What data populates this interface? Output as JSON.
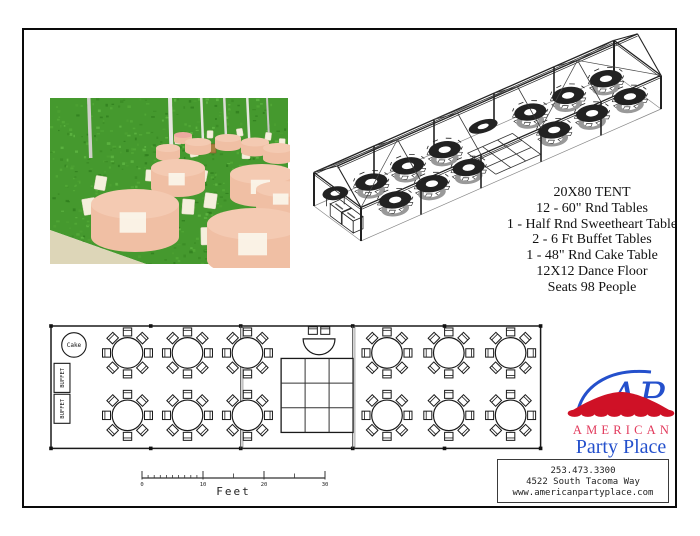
{
  "tent_info": {
    "lines": [
      "20X80 TENT",
      "12 - 60\" Rnd Tables",
      "1 - Half Rnd Sweetheart Table",
      "2 - 6 Ft Buffet Tables",
      "1 - 48\" Rnd Cake Table",
      "12X12 Dance Floor",
      "Seats 98 People"
    ]
  },
  "floor_plan": {
    "tent_length_ft": 80,
    "tent_width_ft": 20,
    "cake_label": "Cake",
    "buffet_label": "BUFFET",
    "chairs_per_table": 8,
    "table_diameter_ft": 5,
    "tables": [
      {
        "u": 12.5,
        "v": 4.4
      },
      {
        "u": 22.3,
        "v": 4.4
      },
      {
        "u": 32.1,
        "v": 4.4
      },
      {
        "u": 12.5,
        "v": 14.6
      },
      {
        "u": 22.3,
        "v": 14.6
      },
      {
        "u": 32.1,
        "v": 14.6
      },
      {
        "u": 54.9,
        "v": 4.4
      },
      {
        "u": 65.0,
        "v": 4.4
      },
      {
        "u": 75.1,
        "v": 4.4
      },
      {
        "u": 54.9,
        "v": 14.6
      },
      {
        "u": 65.0,
        "v": 14.6
      },
      {
        "u": 75.1,
        "v": 14.6
      }
    ],
    "cake": {
      "u": 3.75,
      "v": 3.1,
      "diameter_ft": 4
    },
    "buffets": [
      {
        "u": 0.5,
        "v": 6.1,
        "w": 2.6,
        "h": 4.75
      },
      {
        "u": 0.5,
        "v": 11.15,
        "w": 2.6,
        "h": 4.75
      }
    ],
    "sweetheart": {
      "u": 43.8,
      "v": 2.1,
      "radius_ft": 2.6
    },
    "dance_floor": {
      "u": 37.6,
      "v": 5.3,
      "size_ft": 12,
      "grid": 3
    },
    "dividers_ft": [
      31,
      49.3
    ],
    "stakes_ft": [
      0,
      16.3,
      31,
      49.3,
      64.3,
      80
    ]
  },
  "scale_bar": {
    "ticks": [
      "0",
      "10",
      "20",
      "30"
    ],
    "units_per_major": 10,
    "label": "Feet"
  },
  "logo": {
    "monogram": "AP",
    "line1": "AMERICAN",
    "line2": "Party Place"
  },
  "contact": {
    "lines": [
      "253.473.3300",
      "4522 South Tacoma Way",
      "www.americanpartyplace.com"
    ]
  },
  "colors": {
    "line": "#1a1a1a",
    "logo_blue": "#2450cc",
    "logo_red": "#cf1126",
    "logo_pink_red": "#e23a5c",
    "grass_base": "#45992e",
    "grass_shades": [
      "#3a8a24",
      "#54ab38",
      "#2f7d1d",
      "#62b945",
      "#4da133"
    ],
    "table_top": "#f4cab2",
    "table_side": "#f0bfa4",
    "chair_cream": "#f5efdc",
    "sand": "#ddd6b8"
  }
}
